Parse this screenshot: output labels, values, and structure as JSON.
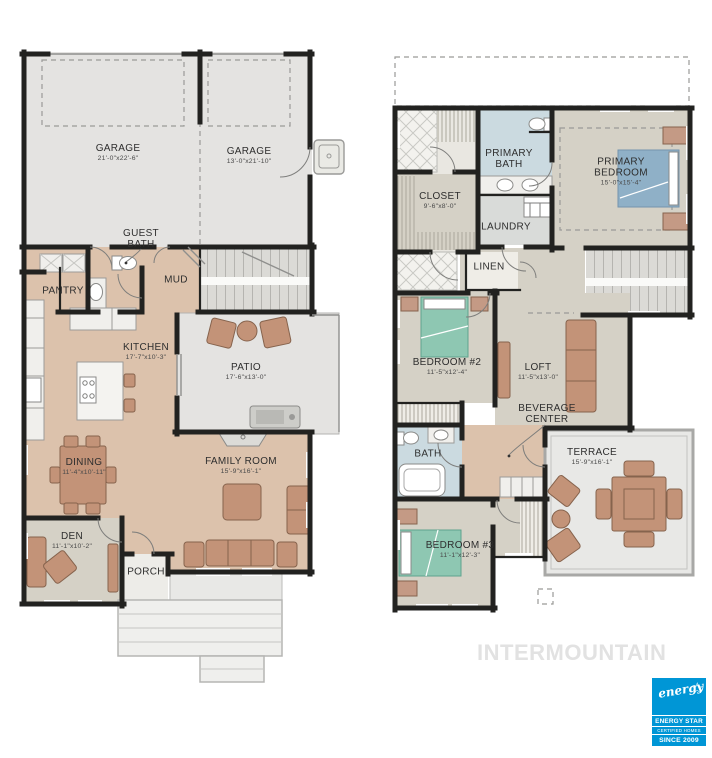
{
  "palette": {
    "wall": "#222220",
    "beige": "#dcc2ac",
    "room2": "#d5d1c6",
    "gray-floor": "#e4e3e1",
    "bath-blue": "#cbdae0",
    "teal": "#8ec7b2",
    "bluebed": "#8fb0c7",
    "furn": "#c39378",
    "furn-line": "#86634d",
    "rose": "#c49a85",
    "counter-f": "#f0efec",
    "terrace": "#e8e8e6",
    "watermark": "#e2e2e2",
    "energy": "#0096d6",
    "label": "#2e2e2e"
  },
  "floor1": {
    "garage_left": {
      "name": "GARAGE",
      "dims": "21'-0\"x22'-6\""
    },
    "garage_right": {
      "name": "GARAGE",
      "dims": "13'-0\"x21'-10\""
    },
    "guest_bath": {
      "name": "GUEST BATH"
    },
    "mud": {
      "name": "MUD"
    },
    "pantry": {
      "name": "PANTRY"
    },
    "kitchen": {
      "name": "KITCHEN",
      "dims": "17'-7\"x10'-3\""
    },
    "patio": {
      "name": "PATIO",
      "dims": "17'-6\"x13'-0\""
    },
    "dining": {
      "name": "DINING",
      "dims": "11'-4\"x10'-11\""
    },
    "family_room": {
      "name": "FAMILY ROOM",
      "dims": "15'-9\"x16'-1\""
    },
    "den": {
      "name": "DEN",
      "dims": "11'-1\"x10'-2\""
    },
    "porch": {
      "name": "PORCH"
    }
  },
  "floor2": {
    "primary_bath": {
      "name": "PRIMARY BATH"
    },
    "closet": {
      "name": "CLOSET",
      "dims": "9'-6\"x8'-0\""
    },
    "primary_bedroom": {
      "name": "PRIMARY BEDROOM",
      "dims": "15'-0\"x15'-4\""
    },
    "laundry": {
      "name": "LAUNDRY"
    },
    "linen": {
      "name": "LINEN"
    },
    "bedroom2": {
      "name": "BEDROOM #2",
      "dims": "11'-5\"x12'-4\""
    },
    "loft": {
      "name": "LOFT",
      "dims": "11'-5\"x13'-0\""
    },
    "beverage_center": {
      "name": "BEVERAGE CENTER"
    },
    "bath": {
      "name": "BATH"
    },
    "terrace": {
      "name": "TERRACE",
      "dims": "15'-9\"x16'-1\""
    },
    "bedroom3": {
      "name": "BEDROOM #3",
      "dims": "11'-1\"x12'-3\""
    }
  },
  "branding": {
    "watermark": "INTERMOUNTAIN",
    "energy_star": {
      "script": "energy",
      "line1": "ENERGY STAR",
      "line2": "CERTIFIED HOMES",
      "line3": "SINCE 2009"
    }
  }
}
